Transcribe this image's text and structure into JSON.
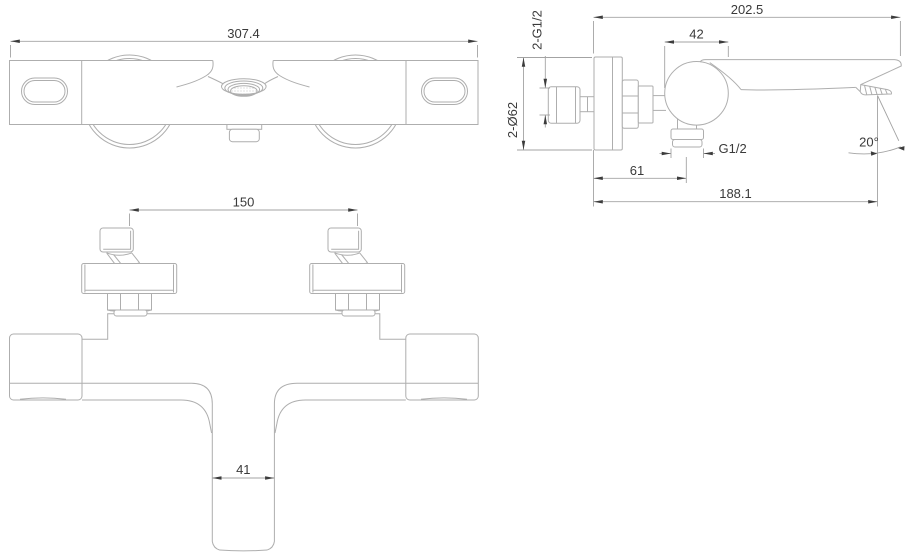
{
  "drawing": {
    "product": "wall-mounted thermostatic bath shower mixer",
    "dimensions": {
      "front": {
        "overall_width": "307.4"
      },
      "side": {
        "overall_depth": "202.5",
        "body_knob_width": "42",
        "inlet_connections": "2-G1/2",
        "escutcheon_diameter": "2-Ø62",
        "shower_outlet_thread": "G1/2",
        "shower_outlet_offset": "61",
        "spout_reach": "188.1",
        "spout_angle": "20°"
      },
      "top": {
        "inlet_center_distance": "150",
        "spout_width": "41"
      }
    },
    "colors": {
      "background": "#ffffff",
      "outline": "#aeaeae",
      "dimension_line": "#a3a3a3",
      "arrow": "#3c3c3c",
      "text": "#3a3a3a"
    }
  }
}
